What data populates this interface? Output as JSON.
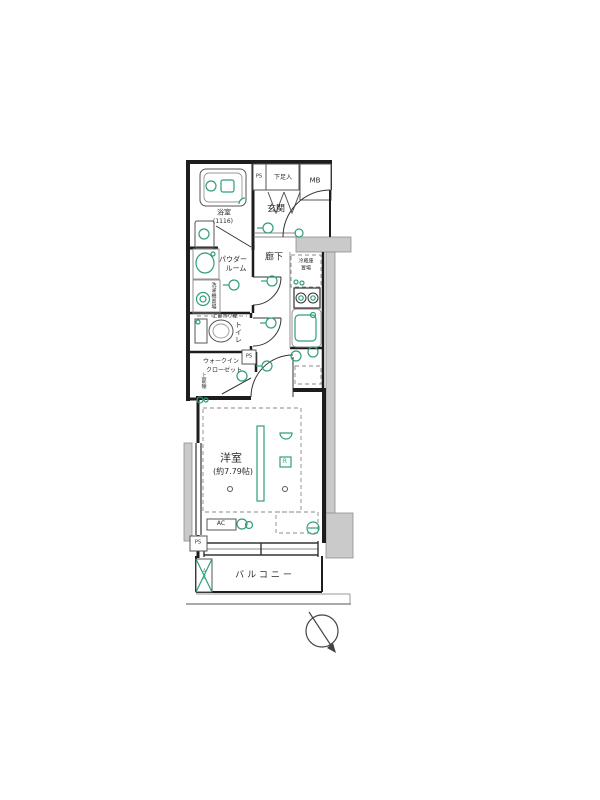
{
  "colors": {
    "accent_green": "#2f9e7c",
    "wall": "#1d1d1d",
    "exterior_gray": "#cacaca"
  },
  "labels": {
    "bathroom": "浴室",
    "bathroom_size": "(1116)",
    "ps": "PS",
    "shoe_cabinet": "下足入",
    "meter_box": "MB",
    "entrance": "玄関",
    "hallway": "廊下",
    "powder_room_1": "パウダー",
    "powder_room_2": "ルーム",
    "fridge_1": "冷蔵庫",
    "fridge_2": "置場",
    "washer": "洗濯機置場",
    "upper_hanging_shelf": "上部吊り棚",
    "toilet": "トイレ",
    "wic_1": "ウォークイン",
    "wic_2": "クローゼット",
    "upper_shelf": "上部棚",
    "western_room": "洋室",
    "western_room_size": "(約7.79帖)",
    "remote": "R",
    "ac": "AC",
    "balcony": "バルコニー"
  }
}
